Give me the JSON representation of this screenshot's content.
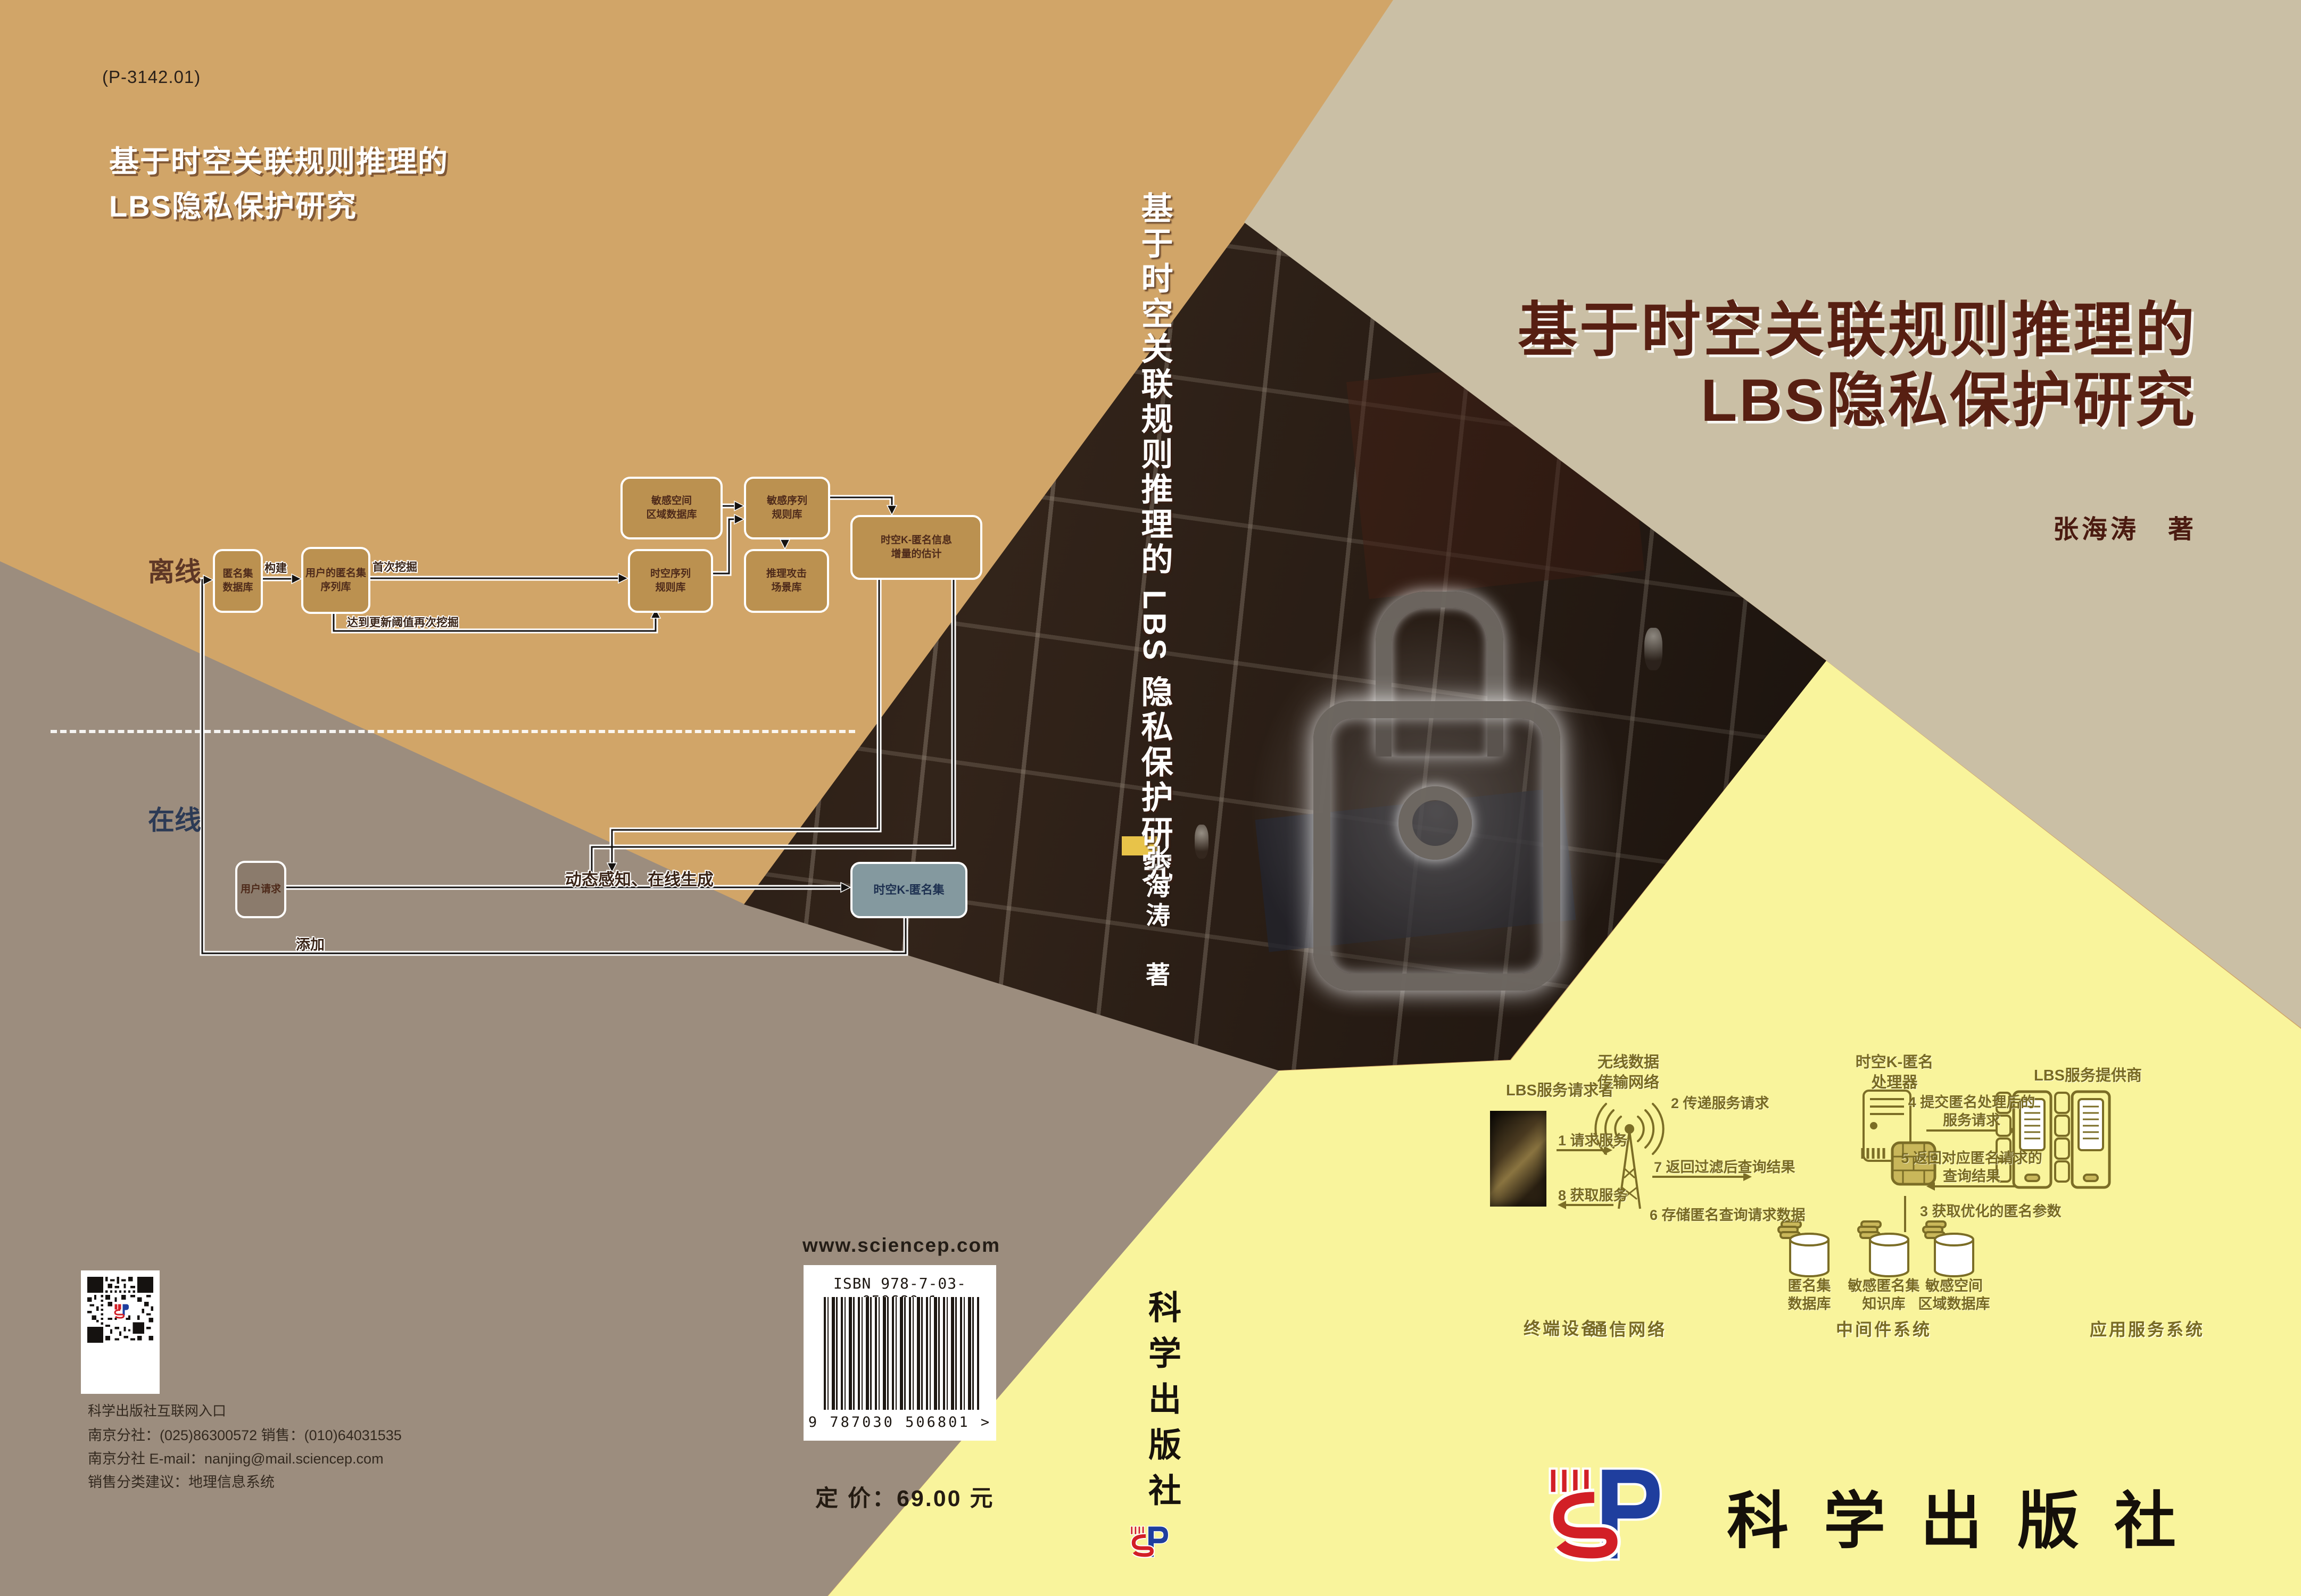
{
  "colors": {
    "tan": "#d1a568",
    "gray_brown": "#9c8d7e",
    "beige": "#cabfa5",
    "yellow": "#f9f49c",
    "title_maroon": "#571f12",
    "olive": "#7b6d26",
    "box_tan": "#bb9150",
    "box_blue": "#84999f",
    "logo_red": "#d21f26",
    "logo_blue": "#1f3e9e"
  },
  "back": {
    "code": "(P-3142.01)",
    "title_line1": "基于时空关联规则推理的",
    "title_line2": "LBS隐私保护研究",
    "flow": {
      "offline": "离线",
      "online": "在线",
      "anon_l1": "匿名集",
      "anon_l2": "数据库",
      "userseq_l1": "用户的匿名集",
      "userseq_l2": "序列库",
      "strule_l1": "时空序列",
      "strule_l2": "规则库",
      "sensarea_l1": "敏感空间",
      "sensarea_l2": "区域数据库",
      "sensrule_l1": "敏感序列",
      "sensrule_l2": "规则库",
      "attack_l1": "推理攻击",
      "attack_l2": "场景库",
      "kinfo_l1": "时空K-匿名信息",
      "kinfo_l2": "增量的估计",
      "userreq": "用户请求",
      "kset": "时空K-匿名集",
      "lbl_build": "构建",
      "lbl_firstmine": "首次挖掘",
      "lbl_threshold": "达到更新阈值再次挖掘",
      "lbl_dynamic": "动态感知、在线生成",
      "lbl_add": "添加"
    },
    "qr_caption": "科学出版社互联网入口",
    "contact_line1": "南京分社：(025)86300572  销售：(010)64031535",
    "contact_line2": "南京分社 E-mail：nanjing@mail.sciencep.com",
    "contact_line3": "销售分类建议：地理信息系统",
    "website": "www.sciencep.com",
    "isbn_text": "ISBN 978-7-03-050680-1",
    "barcode_digits": "9 787030 506801 >",
    "price": "定 价：69.00 元"
  },
  "spine": {
    "title": "基于时空关联规则推理的 LBS 隐私保护研究",
    "author": "张海涛",
    "author_suffix": "著",
    "publisher": "科学出版社"
  },
  "front": {
    "title_line1": "基于时空关联规则推理的",
    "title_line2": "LBS隐私保护研究",
    "author": "张海涛　著",
    "publisher": "科学出版社",
    "diagram": {
      "requester": "LBS服务请求者",
      "network_l1": "无线数据",
      "network_l2": "传输网络",
      "processor_l1": "时空K-匿名",
      "processor_l2": "处理器",
      "provider": "LBS服务提供商",
      "step1": "1 请求服务",
      "step8": "8 获取服务",
      "step2": "2 传递服务请求",
      "step7": "7 返回过滤后查询结果",
      "step6": "6 存储匿名查询请求数据",
      "step4_l1": "4 提交匿名处理后的",
      "step4_l2": "服务请求",
      "step5_l1": "5 返回对应匿名请求的",
      "step5_l2": "查询结果",
      "step3": "3 获取优化的匿名参数",
      "db1_l1": "匿名集",
      "db1_l2": "数据库",
      "db2_l1": "敏感匿名集",
      "db2_l2": "知识库",
      "db3_l1": "敏感空间",
      "db3_l2": "区域数据库",
      "tier1": "终端设备",
      "tier2": "通信网络",
      "tier3": "中间件系统",
      "tier4": "应用服务系统"
    }
  }
}
